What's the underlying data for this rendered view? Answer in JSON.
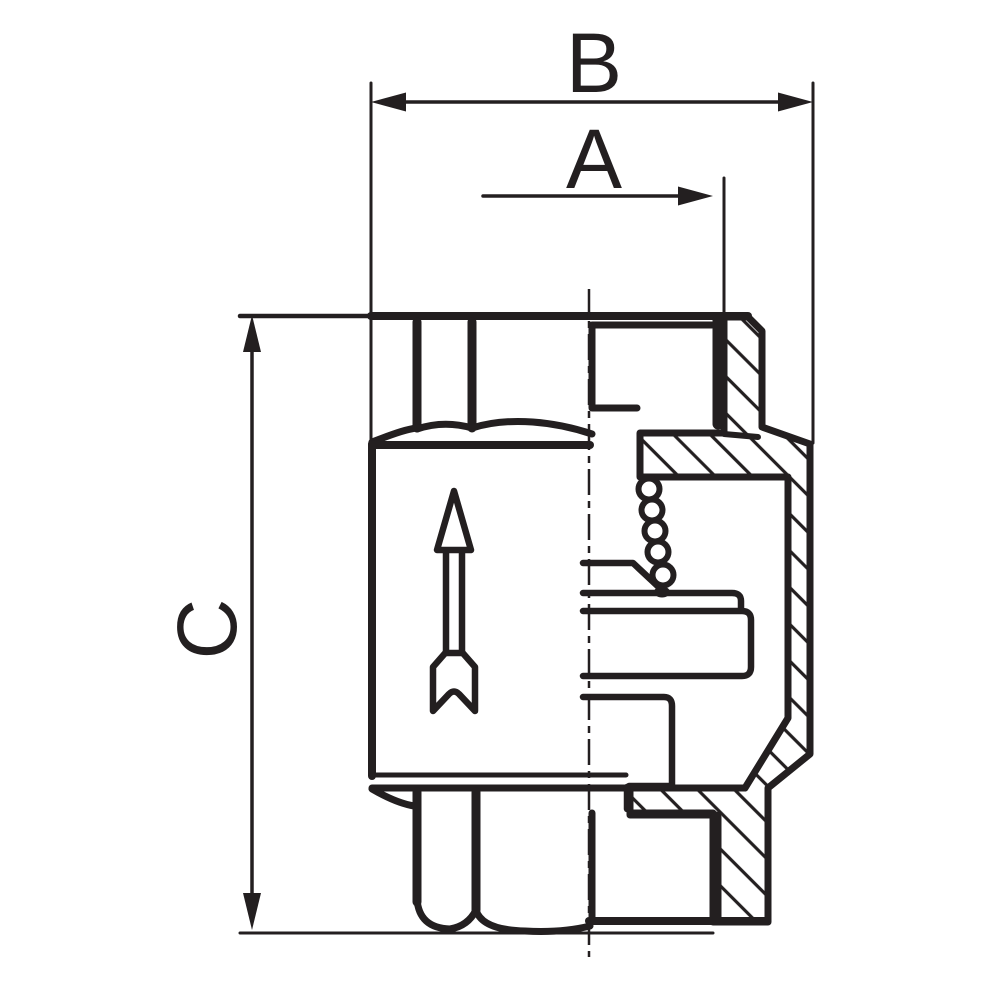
{
  "page": {
    "background_color": "#ffffff",
    "ink_color": "#231f20"
  },
  "drawing": {
    "kind": "check-valve cross-section technical drawing",
    "labels": {
      "width_dim": "B",
      "port_dim": "A",
      "height_dim": "C"
    },
    "dimensions": [
      {
        "id": "B",
        "orientation": "horizontal",
        "style": "double-headed-arrow",
        "measures": "overall width across body"
      },
      {
        "id": "A",
        "orientation": "horizontal",
        "style": "single-arrow-to-port",
        "measures": "port offset"
      },
      {
        "id": "C",
        "orientation": "vertical",
        "style": "double-headed-arrow",
        "measures": "overall height"
      }
    ],
    "features": {
      "spring_coils": 5,
      "flow_direction": "up",
      "hatch_angle_deg": 45,
      "section_side": "right-of-centerline"
    }
  }
}
